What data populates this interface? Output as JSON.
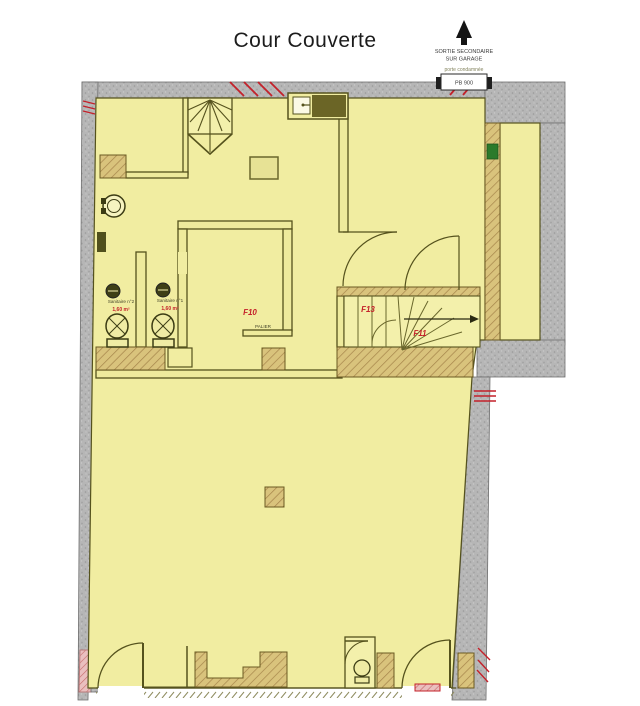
{
  "title": "Cour Couverte",
  "annotations": {
    "secondary_exit_line1": "SORTIE SECONDAIRE",
    "secondary_exit_line2": "SUR GARAGE",
    "door_note": "porte condamnée",
    "door_tag": "PB 900"
  },
  "rooms": {
    "sanitaire2": {
      "name": "Sanitaire n°2",
      "area": "1,60 m²"
    },
    "sanitaire1": {
      "name": "Sanitaire n°1",
      "area": "1,60 m²"
    },
    "palier": {
      "code": "F10",
      "label": "PALIER"
    },
    "stairwell": {
      "code_a": "F13",
      "code_b": "F11"
    }
  },
  "colors": {
    "floor": "#f1eda1",
    "wall_concrete": "#b6b6b6",
    "wall_interior_line": "#55521d",
    "wood_hatch": "#d9c37c",
    "annotation_red": "#c4212a",
    "marker_green": "#2b7a2b",
    "pink_wall": "#eabfbf"
  }
}
